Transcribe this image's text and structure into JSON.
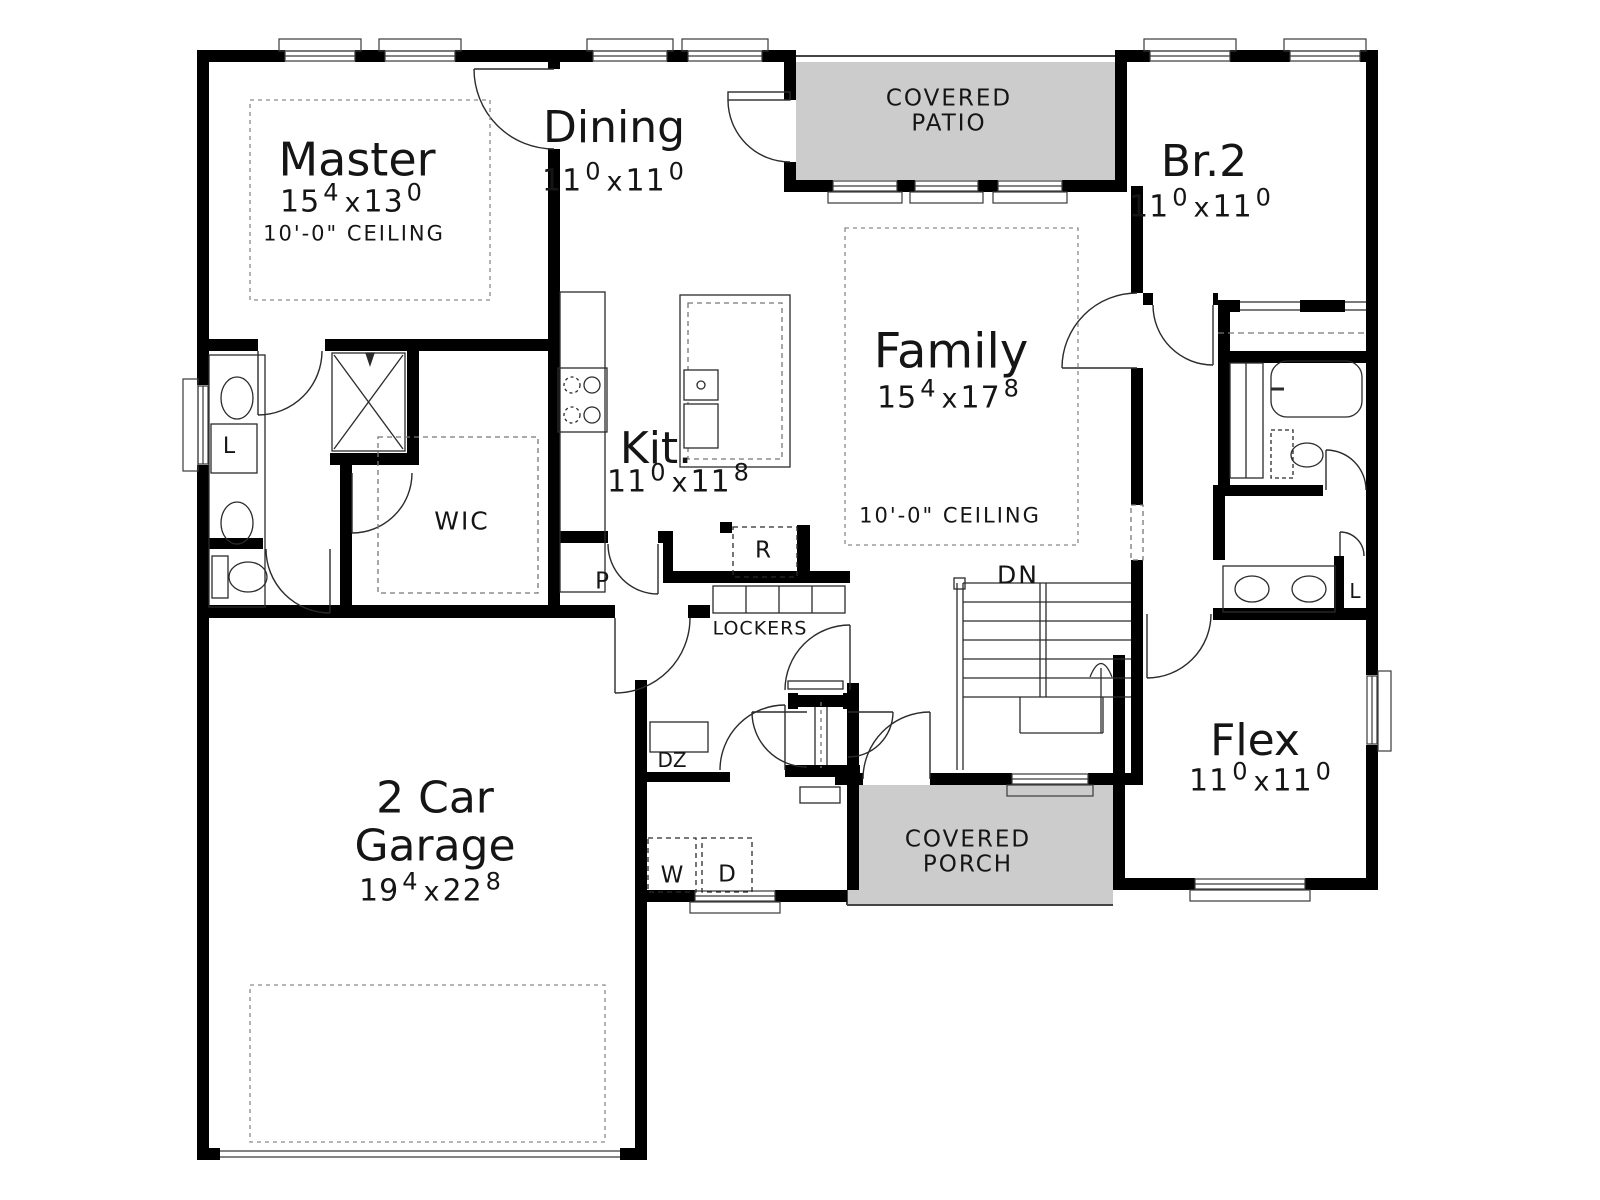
{
  "colors": {
    "wall": "#000000",
    "outdoor_fill": "#cccccc",
    "line": "#2b2b2b",
    "bg": "#ffffff"
  },
  "rooms": {
    "master": {
      "name": "Master",
      "dim": {
        "n1": "15",
        "s1": "4",
        "x": "x",
        "n2": "13",
        "s2": "0"
      },
      "ceiling": "10'-0\" CEILING"
    },
    "dining": {
      "name": "Dining",
      "dim": {
        "n1": "11",
        "s1": "0",
        "x": "x",
        "n2": "11",
        "s2": "0"
      }
    },
    "covered_patio": {
      "line1": "COVERED",
      "line2": "PATIO"
    },
    "br2": {
      "name": "Br.2",
      "dim": {
        "n1": "11",
        "s1": "0",
        "x": "x",
        "n2": "11",
        "s2": "0"
      }
    },
    "family": {
      "name": "Family",
      "dim": {
        "n1": "15",
        "s1": "4",
        "x": "x",
        "n2": "17",
        "s2": "8"
      },
      "ceiling": "10'-0\" CEILING"
    },
    "kitchen": {
      "name": "Kit.",
      "dim": {
        "n1": "11",
        "s1": "0",
        "x": "x",
        "n2": "11",
        "s2": "8"
      }
    },
    "wic": {
      "name": "WIC"
    },
    "flex": {
      "name": "Flex",
      "dim": {
        "n1": "11",
        "s1": "0",
        "x": "x",
        "n2": "11",
        "s2": "0"
      }
    },
    "garage": {
      "line1": "2 Car",
      "line2": "Garage",
      "dim": {
        "n1": "19",
        "s1": "4",
        "x": "x",
        "n2": "22",
        "s2": "8"
      }
    },
    "covered_porch": {
      "line1": "COVERED",
      "line2": "PORCH"
    }
  },
  "fixtures": {
    "lockers": "LOCKERS",
    "stairs_down": "DN",
    "drop_zone": "DZ",
    "washer": "W",
    "dryer": "D",
    "pantry": "P",
    "refrigerator": "R",
    "linen_master": "L",
    "linen_bath": "L"
  }
}
